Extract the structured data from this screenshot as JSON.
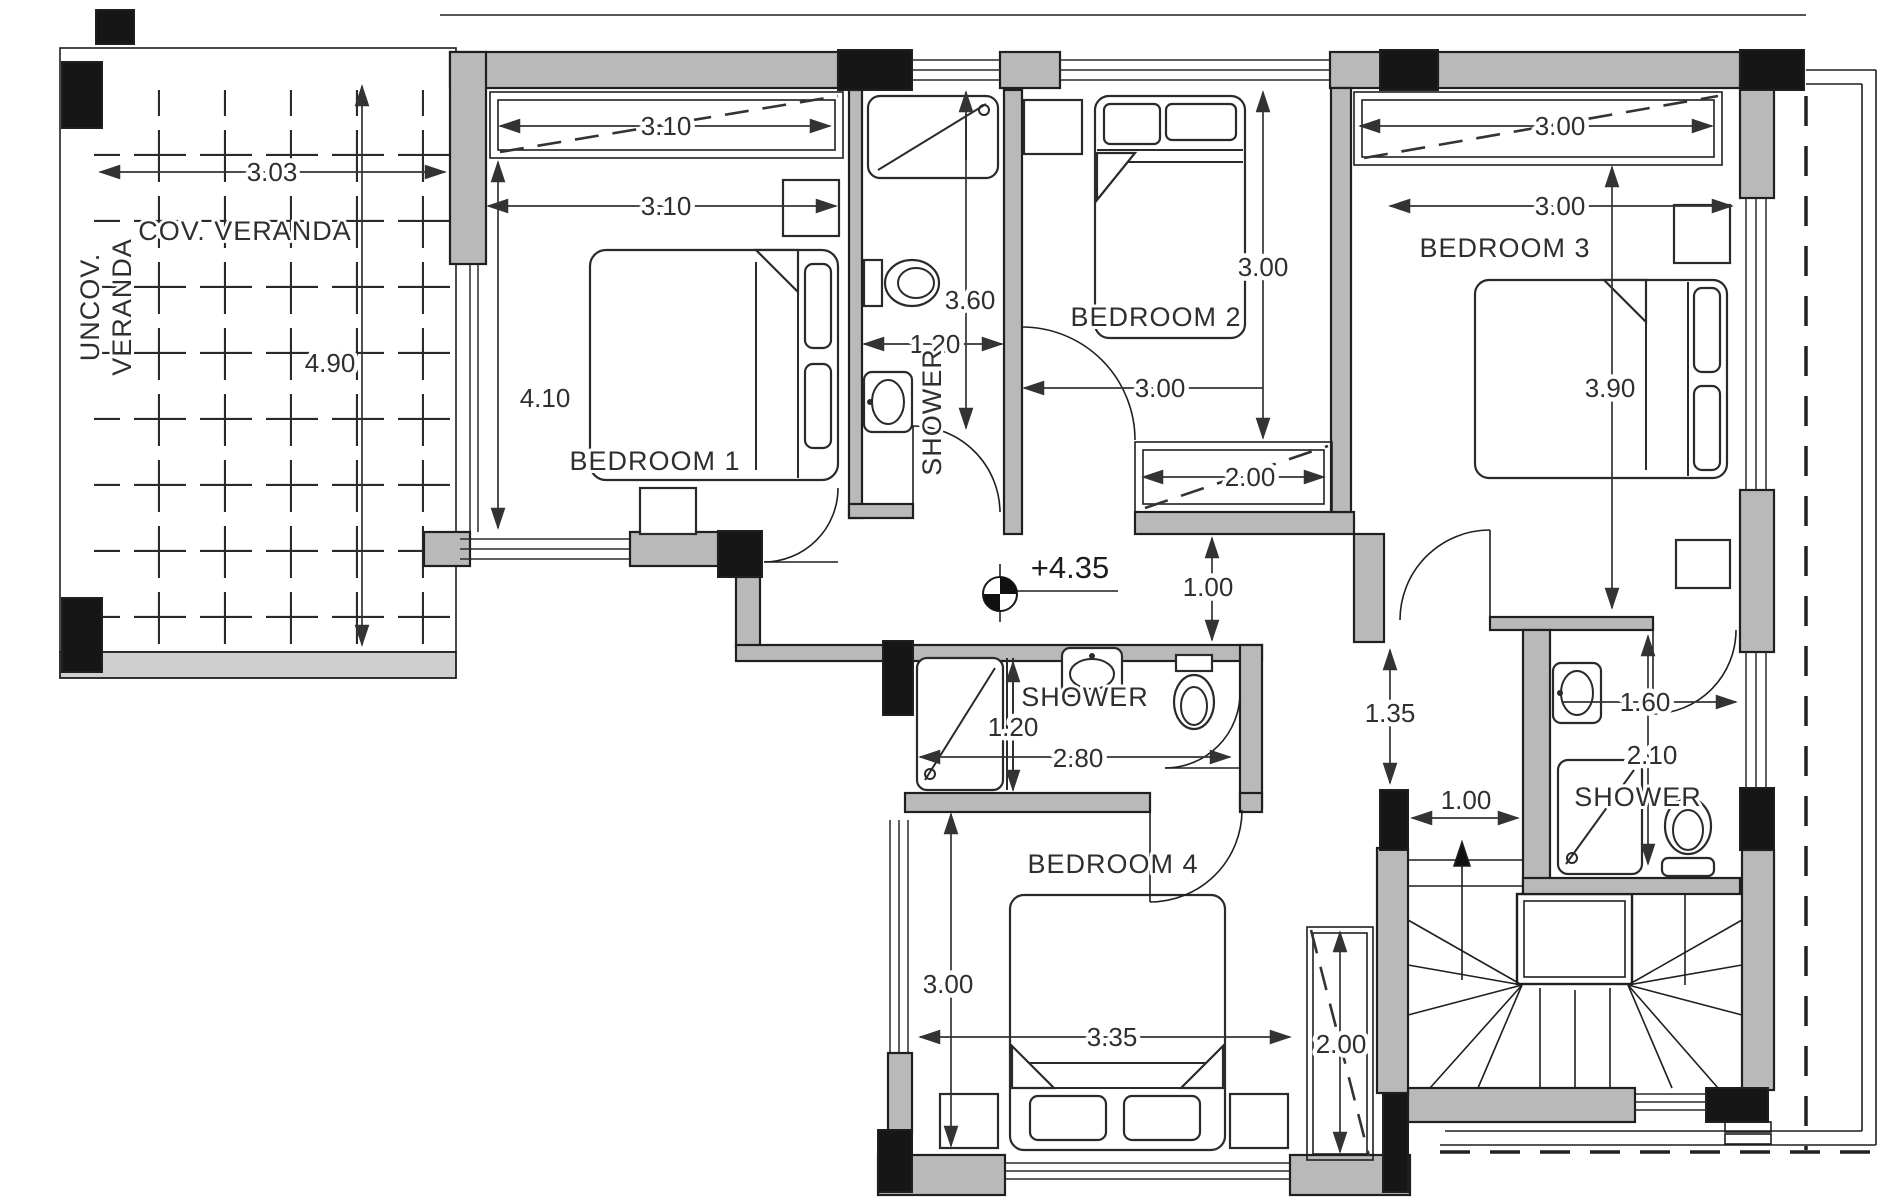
{
  "plan": {
    "level_marker": "+4.35",
    "rooms": {
      "cov_veranda": "COV. VERANDA",
      "uncov_veranda_line1": "UNCOV.",
      "uncov_veranda_line2": "VERANDA",
      "bedroom1": "BEDROOM 1",
      "bedroom2": "BEDROOM 2",
      "bedroom3": "BEDROOM 3",
      "bedroom4": "BEDROOM 4",
      "shower_top": "SHOWER",
      "shower_middle": "SHOWER",
      "shower_right": "SHOWER"
    },
    "dimensions": {
      "veranda_width": "3.03",
      "veranda_depth": "4.90",
      "bedroom1_wardrobe_width": "3.10",
      "bedroom1_width": "3.10",
      "bedroom1_depth": "4.10",
      "shower_top_depth": "3.60",
      "shower_top_width": "1.20",
      "bedroom2_depth": "3.00",
      "bedroom2_width": "3.00",
      "bedroom2_wardrobe_width": "2.00",
      "bedroom3_wardrobe_width": "3.00",
      "bedroom3_width": "3.00",
      "bedroom3_depth": "3.90",
      "hall_opening": "1.00",
      "corridor_width": "1.35",
      "shower_middle_tray": "1.20",
      "shower_middle_width": "2.80",
      "stair_landing_width": "1.00",
      "shower_right_width": "1.60",
      "shower_right_depth": "2.10",
      "bedroom4_depth": "3.00",
      "bedroom4_width": "3.35",
      "bedroom4_wardrobe_depth": "2.00"
    }
  },
  "colors": {
    "wall_fill": "#b9b9b9",
    "column_fill": "#161616",
    "veranda_band": "#cfcfcf",
    "line": "#1f1f1f",
    "paper": "#ffffff"
  }
}
